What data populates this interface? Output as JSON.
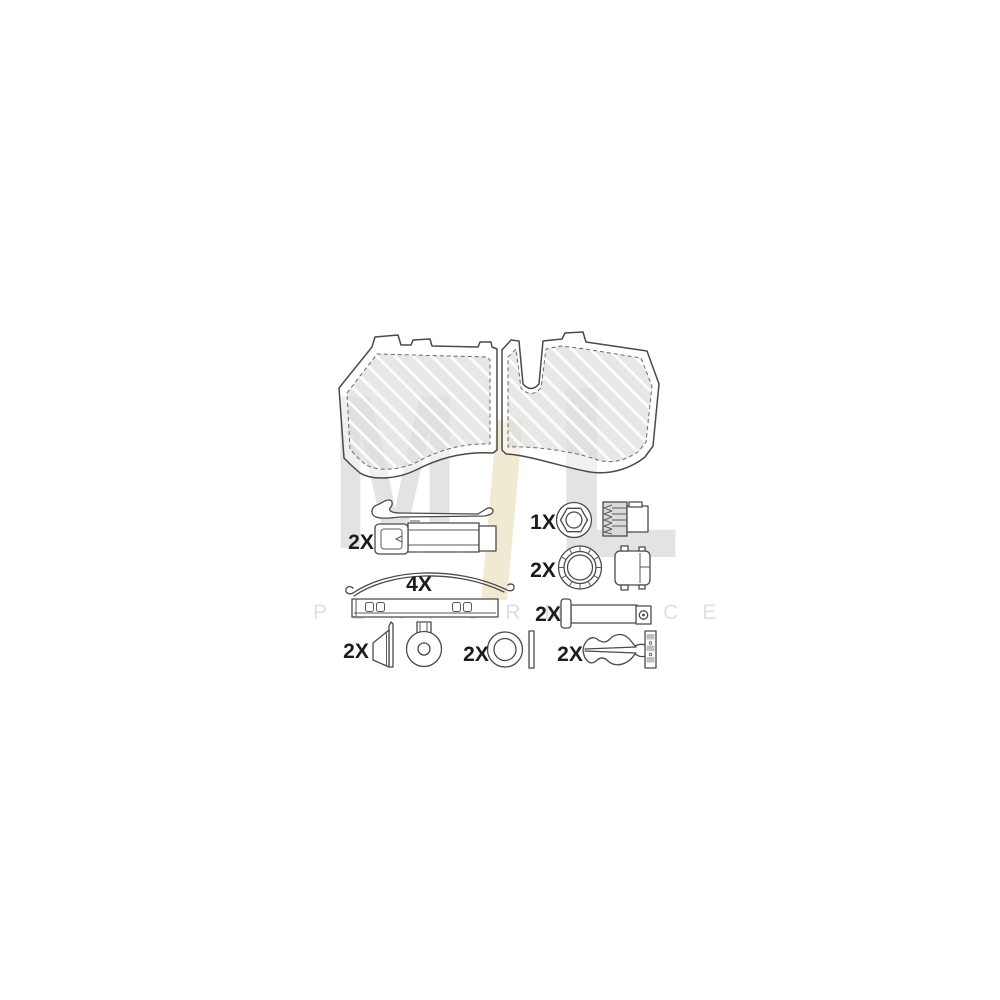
{
  "page": {
    "background_color": "#ffffff"
  },
  "watermark": {
    "letter_m": "M",
    "letter_l": "L",
    "tagline": "PERFORMANCE",
    "letter_color": "#e3e3e3",
    "accent_color": "#f1ead2",
    "tagline_color": "#e0e0e0"
  },
  "drawing": {
    "line_color": "#4a4a4a",
    "friction_fill": "#e2e2e0",
    "description": "Brake pad set (pair, hatched friction surface) with accessory fitting kit"
  },
  "parts": [
    {
      "name": "pad-retainer-spring",
      "qty": "2X"
    },
    {
      "name": "leaf-spring",
      "qty": "4X"
    },
    {
      "name": "hex-bushing-with-splined-cap",
      "qty": "1X"
    },
    {
      "name": "seal-ring-with-cap",
      "qty": "2X"
    },
    {
      "name": "clevis-pin",
      "qty": "2X"
    },
    {
      "name": "guide-boot",
      "qty": "2X"
    },
    {
      "name": "washer",
      "qty": "2X"
    },
    {
      "name": "beta-clip",
      "qty": "2X"
    }
  ]
}
